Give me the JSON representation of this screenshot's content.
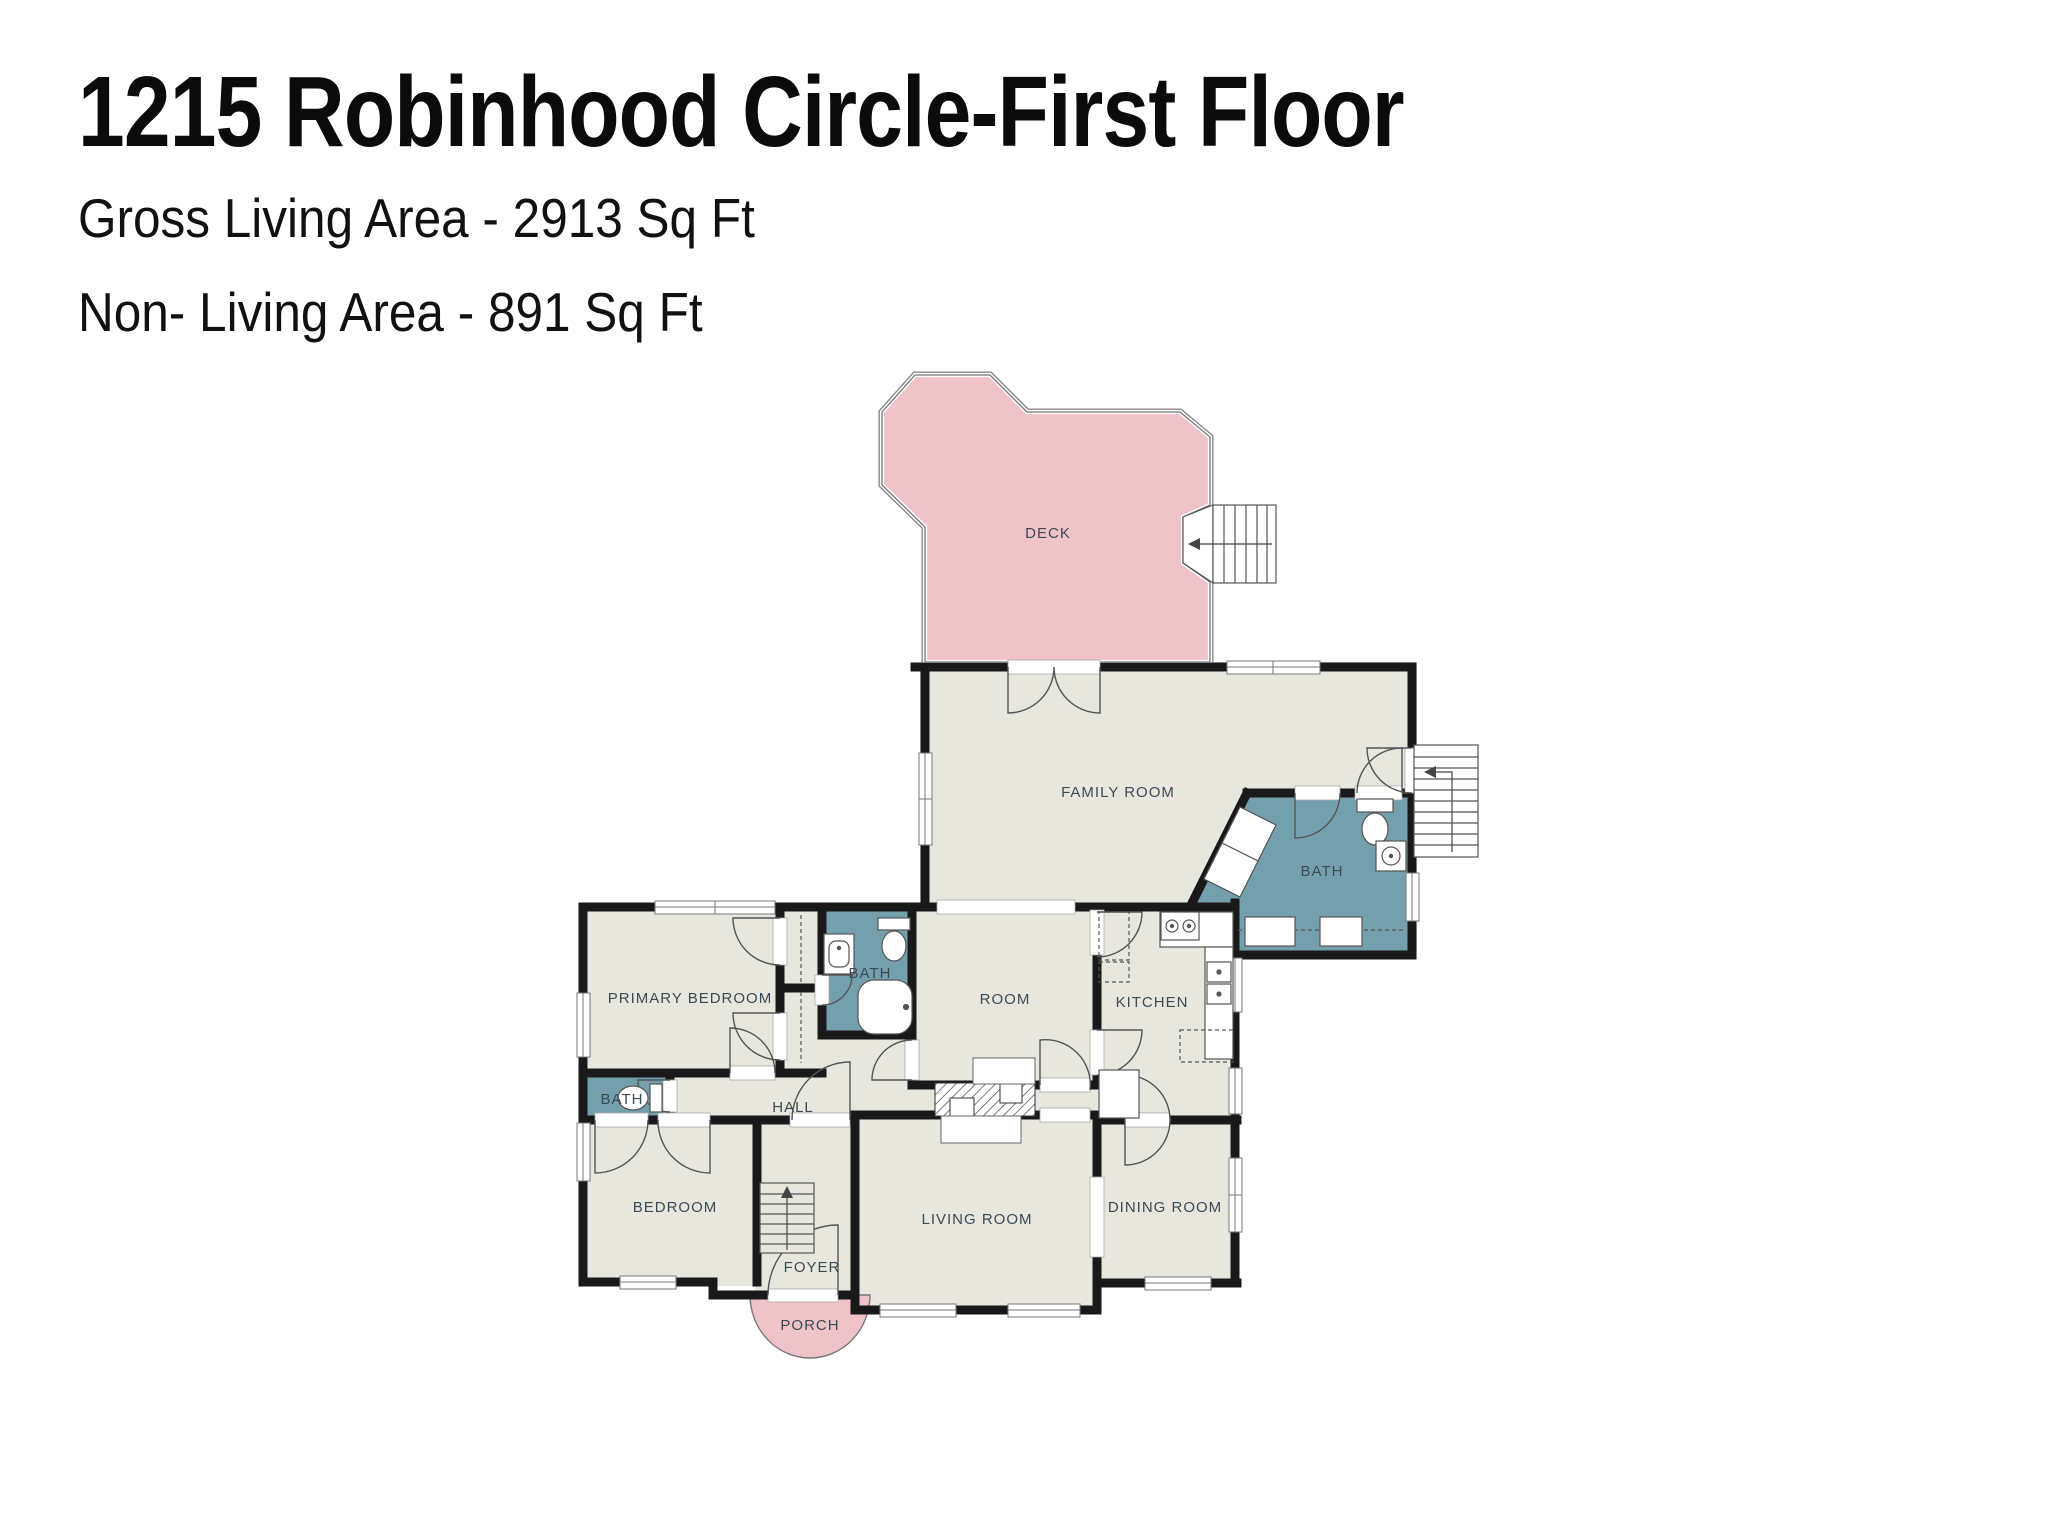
{
  "header": {
    "title": "1215 Robinhood Circle-First Floor",
    "gross_living": "Gross Living Area - 2913 Sq Ft",
    "non_living": "Non- Living Area - 891 Sq Ft"
  },
  "rooms": {
    "deck": "DECK",
    "family_room": "FAMILY ROOM",
    "bath_right": "BATH",
    "primary_bedroom": "PRIMARY BEDROOM",
    "bath_middle": "BATH",
    "room": "ROOM",
    "kitchen": "KITCHEN",
    "hall": "HALL",
    "bath_small": "BATH",
    "bedroom": "BEDROOM",
    "foyer": "FOYER",
    "living_room": "LIVING ROOM",
    "dining_room": "DINING ROOM",
    "porch": "PORCH"
  },
  "colors": {
    "living_area_floor": "#e8e7de",
    "non_living_area": "#f0c3c9",
    "bath_floor": "#74a0ad",
    "walls": "#191919",
    "label_text": "#3c4a52"
  }
}
